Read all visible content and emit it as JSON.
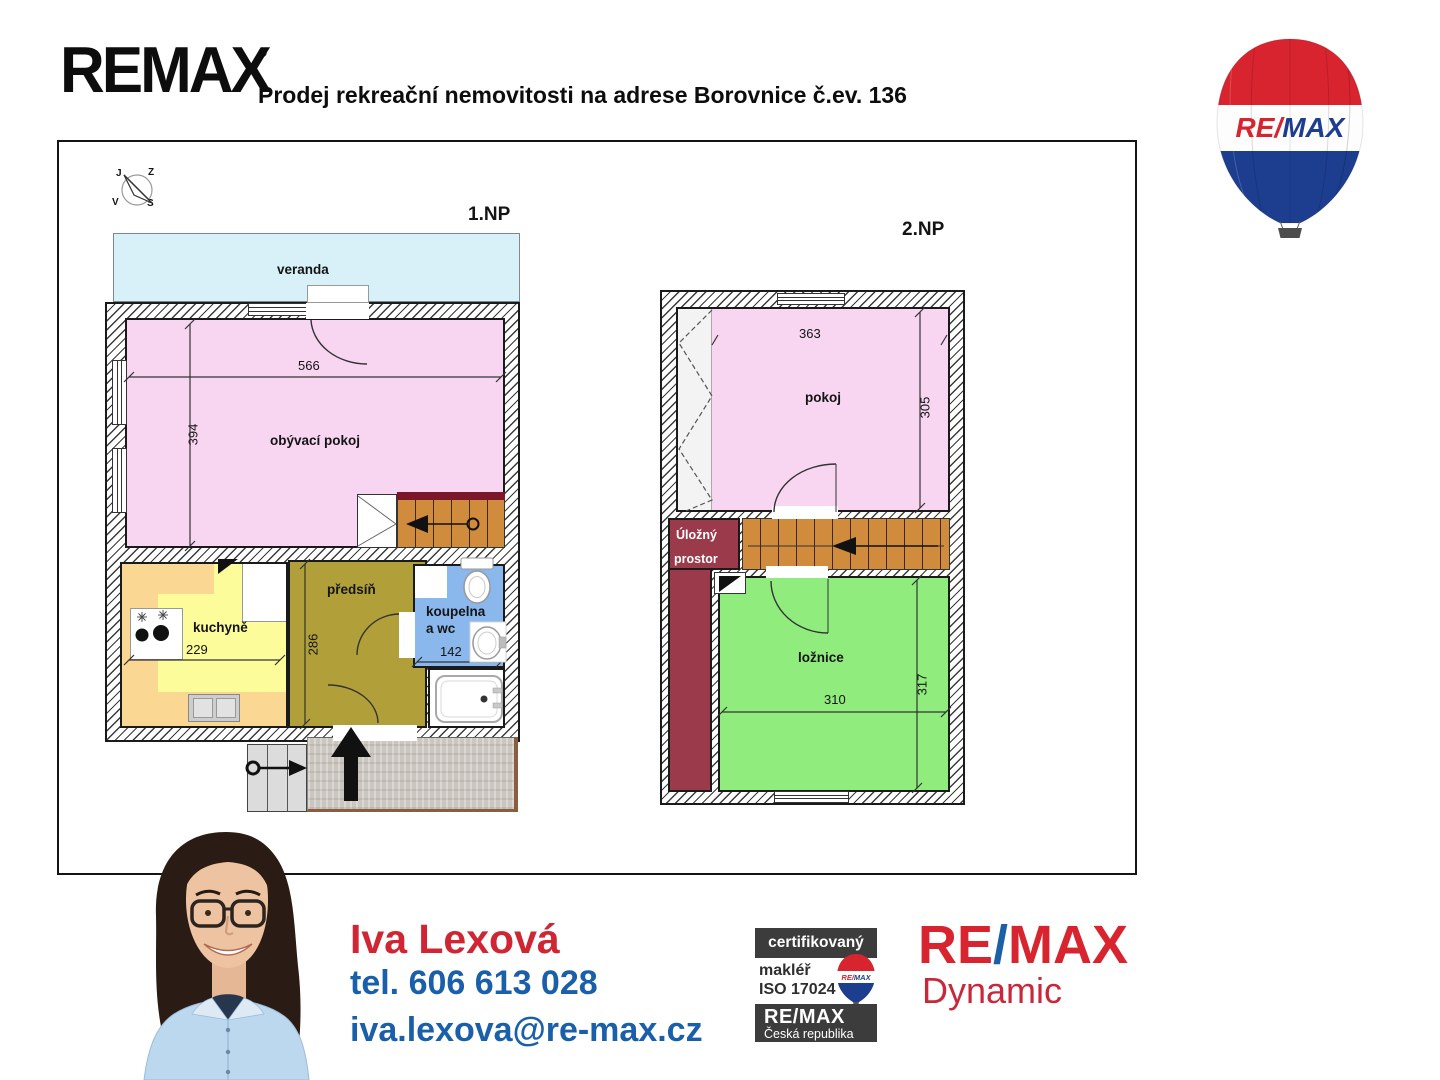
{
  "header": {
    "brand": "REMAX",
    "reg": "®",
    "title": "Prodej rekreační nemovitosti na adrese Borovnice č.ev. 136"
  },
  "balloon": {
    "re": "RE",
    "slash": "/",
    "max": "MAX"
  },
  "compass": {
    "top_left": "J",
    "top_right": "Z",
    "bottom_left": "V",
    "bottom_right": "S"
  },
  "floor1": {
    "label": "1.NP",
    "rooms": {
      "veranda": "veranda",
      "living": "obývací pokoj",
      "kitchen": "kuchyně",
      "hall": "předsíň",
      "bath_l1": "koupelna",
      "bath_l2": "a wc"
    },
    "dims": {
      "living_w": "566",
      "living_h": "394",
      "kitchen_w": "229",
      "hall_h": "286",
      "bath_w": "142"
    }
  },
  "floor2": {
    "label": "2.NP",
    "rooms": {
      "room": "pokoj",
      "storage_l1": "Úložný",
      "storage_l2": "prostor",
      "bedroom": "ložnice"
    },
    "dims": {
      "room_w": "363",
      "room_h": "305",
      "bedroom_w": "310",
      "bedroom_h": "317"
    }
  },
  "agent": {
    "name": "Iva Lexová",
    "phone": "tel. 606 613 028",
    "email": "iva.lexova@re-max.cz"
  },
  "badges": {
    "certified": "certifikovaný",
    "broker": "makléř",
    "iso": "ISO 17024",
    "brand": "RE/MAX",
    "country": "Česká republika",
    "mini_re": "RE",
    "mini_slash": "/",
    "mini_max": "MAX"
  },
  "office": {
    "re": "RE",
    "slash": "/",
    "max": "MAX",
    "name": "Dynamic"
  },
  "colors": {
    "veranda": "#d8f0f8",
    "living_room": "#f8d6f2",
    "kitchen": "#fdfc9b",
    "kitchen_counter": "#fad894",
    "hall": "#b1a039",
    "bathroom": "#8ab7ec",
    "stairs": "#d08b3d",
    "storage": "#9b3a4a",
    "bedroom": "#8fec7d",
    "agent_name_red": "#d02533",
    "contact_blue": "#1a5fa9",
    "logo_red": "#d7242f",
    "logo_blue": "#1b3f94"
  }
}
